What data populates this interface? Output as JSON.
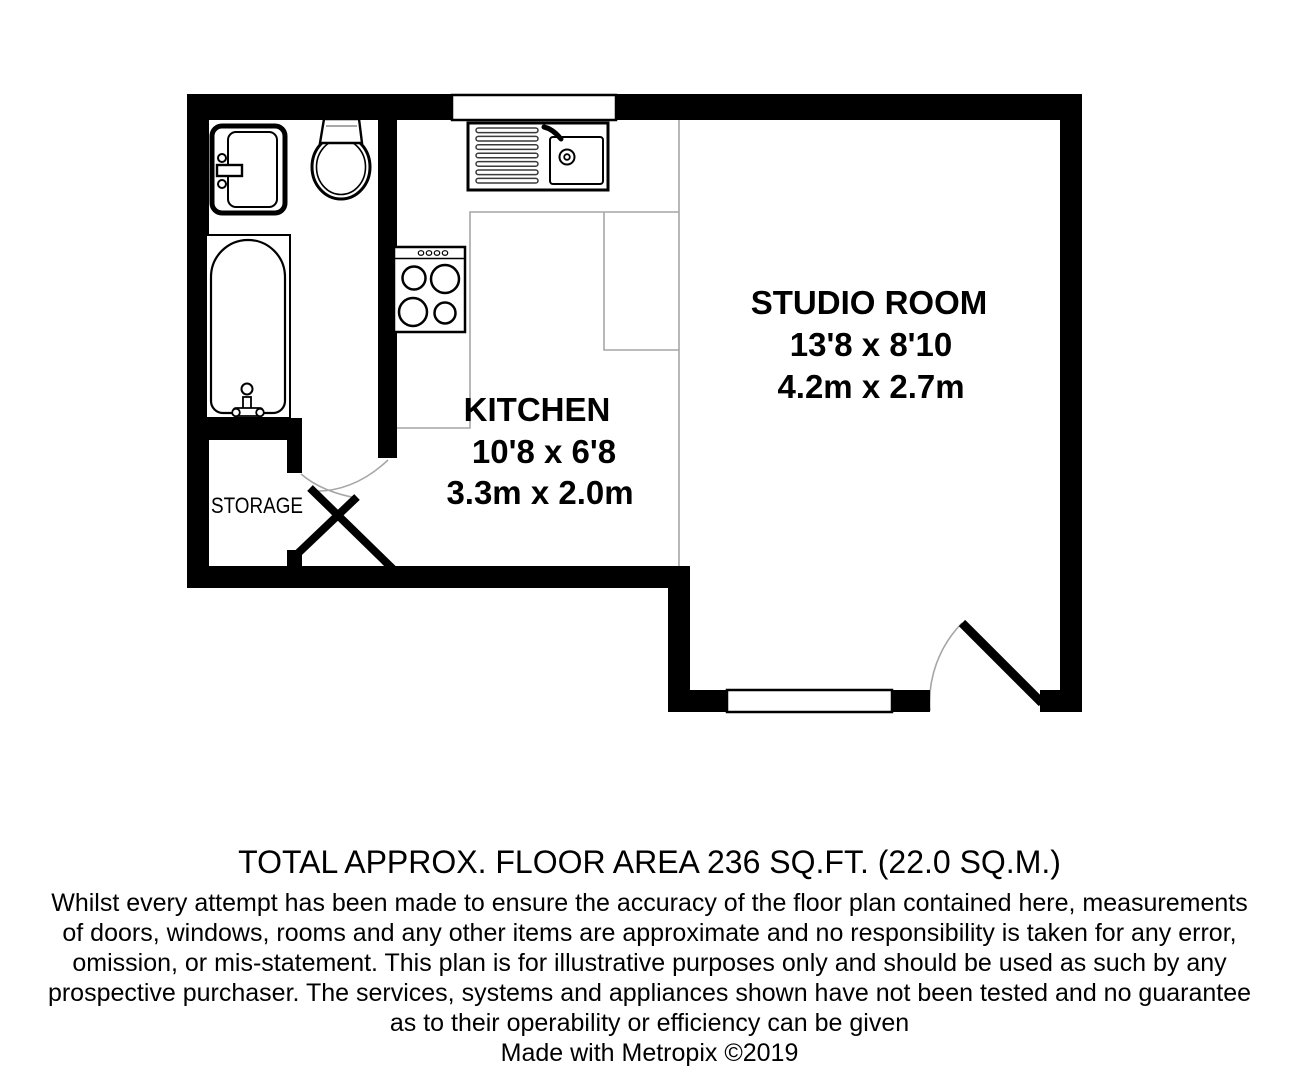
{
  "plan": {
    "rooms": {
      "studio": {
        "name": "STUDIO ROOM",
        "imperial": "13'8 x 8'10",
        "metric": "4.2m x 2.7m"
      },
      "kitchen": {
        "name": "KITCHEN",
        "imperial": "10'8 x 6'8",
        "metric": "3.3m x 2.0m"
      },
      "storage": {
        "name": "STORAGE"
      }
    },
    "fixtures": [
      "bathroom-sink",
      "toilet",
      "bathtub",
      "kitchen-sink-drainer",
      "hob"
    ],
    "colors": {
      "wall": "#000000",
      "thin_line": "#a6a6a6",
      "background": "#ffffff"
    }
  },
  "footer": {
    "total_area": "TOTAL APPROX. FLOOR AREA 236 SQ.FT. (22.0 SQ.M.)",
    "disclaimer_lines": [
      "Whilst every attempt has been made to ensure the accuracy of the floor plan contained here, measurements",
      "of doors, windows, rooms and any other items are approximate and no responsibility is taken for any error,",
      "omission, or mis-statement. This plan is for illustrative purposes only and should be used as such by any",
      "prospective purchaser. The services, systems and appliances shown have not been tested and no guarantee",
      "as to their operability or efficiency can be given"
    ],
    "credit": "Made with Metropix ©2019"
  }
}
